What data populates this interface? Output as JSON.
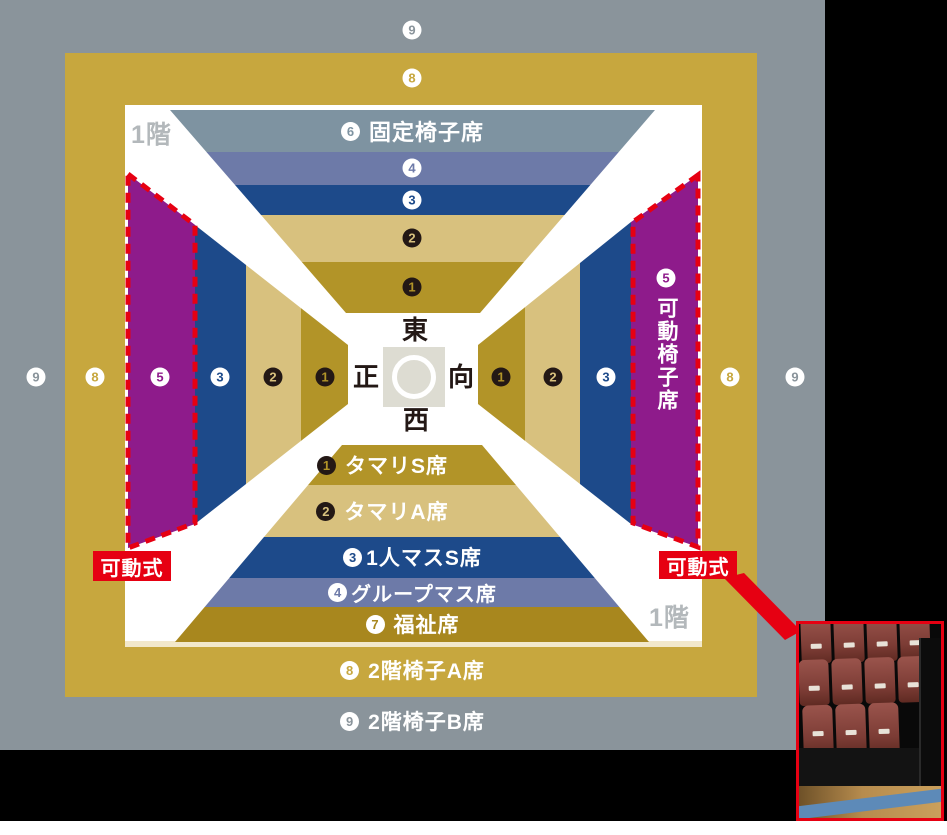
{
  "map": {
    "floor1": "1階",
    "movable": "可動式",
    "center": {
      "east": "東",
      "west": "西",
      "front": "正",
      "back": "向"
    },
    "zones": [
      {
        "num": "1",
        "label": "タマリS席",
        "color": "#b29428",
        "badge": "black"
      },
      {
        "num": "2",
        "label": "タマリA席",
        "color": "#d8c17e",
        "badge": "black"
      },
      {
        "num": "3",
        "label": "1人マスS席",
        "color": "#1d4a8a",
        "badge": "white"
      },
      {
        "num": "4",
        "label": "グループマス席",
        "color": "#6d7aa8",
        "badge": "white"
      },
      {
        "num": "5",
        "label": "可動椅子席",
        "color": "#8e1b8b",
        "badge": "white"
      },
      {
        "num": "6",
        "label": "固定椅子席",
        "color": "#7e93a1",
        "badge": "white"
      },
      {
        "num": "7",
        "label": "福祉席",
        "color": "#a8871e",
        "badge": "white"
      },
      {
        "num": "8",
        "label": "2階椅子A席",
        "color": "#c7a73e",
        "badge": "white"
      },
      {
        "num": "9",
        "label": "2階椅子B席",
        "color": "#8a949b",
        "badge": "white"
      }
    ],
    "accent_red": "#e60012",
    "floor2_bg": "#8a949b",
    "ring_bg": "#c7a73e"
  }
}
